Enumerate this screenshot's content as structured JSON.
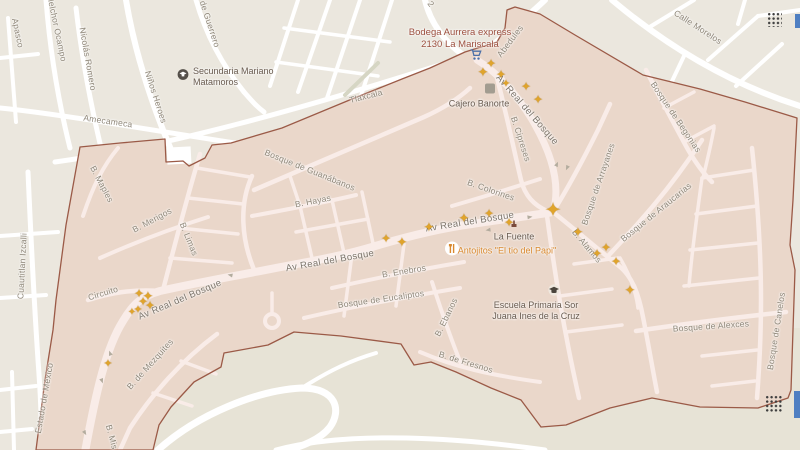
{
  "map": {
    "colors": {
      "background_outside": "#ebe7de",
      "background_outside_south": "#e7e3d6",
      "highlight_region_fill": "#ead7ca",
      "highlight_region_border": "#9b5a47",
      "road_outside": "#ffffff",
      "road_inside": "#f9ece8",
      "street_label": "#8e8678",
      "star_marker": "#e0a42c",
      "poi_shopping": "#9c4f3e",
      "poi_restaurant": "#d9892f",
      "poi_dark": "#685a4e"
    },
    "street_labels": [
      {
        "t": "Apasco",
        "x": 18,
        "y": 33,
        "r": 78,
        "c": "st",
        "s": 8.5
      },
      {
        "t": "Melchor Ocampo",
        "x": 57,
        "y": 28,
        "r": 78,
        "c": "st",
        "s": 8.5
      },
      {
        "t": "Nicolás Romero",
        "x": 88,
        "y": 59,
        "r": 80,
        "c": "st",
        "s": 8.5
      },
      {
        "t": "Niños Heroes",
        "x": 156,
        "y": 97,
        "r": 72,
        "c": "st",
        "s": 8.5
      },
      {
        "t": "de Guerrero",
        "x": 210,
        "y": 24,
        "r": 72,
        "c": "st",
        "s": 8.5
      },
      {
        "t": "Amecameca",
        "x": 108,
        "y": 121,
        "r": 8,
        "c": "st",
        "s": 8.5
      },
      {
        "t": "Tlaxcala",
        "x": 366,
        "y": 96,
        "r": -14,
        "c": "st",
        "s": 8.5
      },
      {
        "t": "2",
        "x": 431,
        "y": 4,
        "r": 55,
        "c": "st",
        "s": 8.5
      },
      {
        "t": "Calle Morelos",
        "x": 698,
        "y": 27,
        "r": 33,
        "c": "st",
        "s": 8.5
      },
      {
        "t": "Cuautitlan Izcalli",
        "x": 22,
        "y": 266,
        "r": -87,
        "c": "st",
        "s": 8.5
      },
      {
        "t": "Estado de México",
        "x": 44,
        "y": 398,
        "r": -80,
        "c": "st",
        "s": 8.5
      },
      {
        "t": "Bosque de Guanábanos",
        "x": 310,
        "y": 170,
        "r": 22,
        "c": "st",
        "s": 8.5
      },
      {
        "t": "B. Hayas",
        "x": 313,
        "y": 201,
        "r": -11,
        "c": "st",
        "s": 8.5
      },
      {
        "t": "B. Maples",
        "x": 102,
        "y": 184,
        "r": 62,
        "c": "st",
        "s": 8.5
      },
      {
        "t": "B. Merigos",
        "x": 152,
        "y": 220,
        "r": -28,
        "c": "st",
        "s": 8.5
      },
      {
        "t": "B. Limas",
        "x": 189,
        "y": 239,
        "r": 68,
        "c": "st",
        "s": 8.5
      },
      {
        "t": "Circuito",
        "x": 103,
        "y": 293,
        "r": -17,
        "c": "st",
        "s": 8.5
      },
      {
        "t": "Av Real del Bosque",
        "x": 180,
        "y": 300,
        "r": -23,
        "c": "stM",
        "s": 9.5
      },
      {
        "t": "Av Real del Bosque",
        "x": 330,
        "y": 261,
        "r": -10,
        "c": "stM",
        "s": 9.5
      },
      {
        "t": "Av Real del Bosque",
        "x": 470,
        "y": 222,
        "r": -9,
        "c": "stM",
        "s": 9.5
      },
      {
        "t": "Av Real del Bosque",
        "x": 527,
        "y": 110,
        "r": 49,
        "c": "stM",
        "s": 9.5
      },
      {
        "t": "Abedules",
        "x": 510,
        "y": 41,
        "r": -53,
        "c": "st",
        "s": 8.5
      },
      {
        "t": "B. Cipreses",
        "x": 521,
        "y": 139,
        "r": 72,
        "c": "st",
        "s": 8.5
      },
      {
        "t": "B. Colorines",
        "x": 491,
        "y": 190,
        "r": 19,
        "c": "st",
        "s": 8.5
      },
      {
        "t": "Bosque de Arrayanes",
        "x": 598,
        "y": 184,
        "r": -71,
        "c": "st",
        "s": 8.5
      },
      {
        "t": "Bosque de Araucarias",
        "x": 656,
        "y": 212,
        "r": -39,
        "c": "st",
        "s": 8.5
      },
      {
        "t": "B. Alamos",
        "x": 587,
        "y": 246,
        "r": 50,
        "c": "st",
        "s": 8.5
      },
      {
        "t": "Bosque de Begonias",
        "x": 676,
        "y": 117,
        "r": 56,
        "c": "st",
        "s": 8.5
      },
      {
        "t": "Bosque de Alexces",
        "x": 711,
        "y": 326,
        "r": -4,
        "c": "st",
        "s": 8.5
      },
      {
        "t": "Bosque de Canelos",
        "x": 776,
        "y": 331,
        "r": -81,
        "c": "st",
        "s": 8.5
      },
      {
        "t": "B. Enebros",
        "x": 404,
        "y": 271,
        "r": -9,
        "c": "st",
        "s": 8.5
      },
      {
        "t": "Bosque de Eucaliptos",
        "x": 381,
        "y": 299,
        "r": -8,
        "c": "st",
        "s": 8.5
      },
      {
        "t": "B. Ebanos",
        "x": 446,
        "y": 317,
        "r": -64,
        "c": "st",
        "s": 8.5
      },
      {
        "t": "B. de Fresnos",
        "x": 466,
        "y": 362,
        "r": 17,
        "c": "st",
        "s": 8.5
      },
      {
        "t": "B. de Mezquites",
        "x": 150,
        "y": 364,
        "r": -48,
        "c": "st",
        "s": 8.5
      },
      {
        "t": "B. Mis",
        "x": 112,
        "y": 437,
        "r": 75,
        "c": "st",
        "s": 8.5
      }
    ],
    "poi_labels": [
      {
        "id": "secundaria",
        "lines": [
          "Secundaria Mariano",
          "Matamoros"
        ],
        "x": 227,
        "y": 76,
        "c": "poiD",
        "s": 9,
        "align": "left",
        "lx": 193
      },
      {
        "id": "bodega",
        "lines": [
          "Bodega Aurrera express",
          "2130 La Mariscala"
        ],
        "x": 460,
        "y": 39,
        "c": "poiM",
        "s": 9.5
      },
      {
        "id": "cajero",
        "lines": [
          "Cajero Banorte"
        ],
        "x": 479,
        "y": 104,
        "c": "poiD",
        "s": 9
      },
      {
        "id": "la-fuente",
        "lines": [
          "La Fuente"
        ],
        "x": 514,
        "y": 237,
        "c": "poiD",
        "s": 9
      },
      {
        "id": "antojitos",
        "lines": [
          "Antojitos \"El tio del Papi\""
        ],
        "x": 507,
        "y": 251,
        "c": "poiO",
        "s": 9
      },
      {
        "id": "escuela",
        "lines": [
          "Escuela Primaria Sor",
          "Juana Ines de la Cruz"
        ],
        "x": 536,
        "y": 311,
        "c": "poiD",
        "s": 9
      }
    ],
    "icons": [
      {
        "name": "school-icon",
        "type": "school",
        "x": 183,
        "y": 77
      },
      {
        "name": "shopping-cart-icon",
        "type": "cart",
        "x": 476,
        "y": 57
      },
      {
        "name": "atm-icon",
        "type": "atm",
        "x": 490,
        "y": 90
      },
      {
        "name": "restaurant-icon",
        "type": "restaurant",
        "x": 452,
        "y": 251
      },
      {
        "name": "fountain-icon",
        "type": "fountain",
        "x": 514,
        "y": 224
      },
      {
        "name": "graduation-cap-icon",
        "type": "gradcap",
        "x": 554,
        "y": 292
      }
    ],
    "stars": [
      {
        "x": 491,
        "y": 64,
        "s": 12
      },
      {
        "x": 483,
        "y": 73,
        "s": 13
      },
      {
        "x": 501,
        "y": 75,
        "s": 12
      },
      {
        "x": 506,
        "y": 84,
        "s": 11
      },
      {
        "x": 526,
        "y": 87,
        "s": 12
      },
      {
        "x": 538,
        "y": 100,
        "s": 12
      },
      {
        "x": 139,
        "y": 294,
        "s": 12
      },
      {
        "x": 148,
        "y": 297,
        "s": 13
      },
      {
        "x": 143,
        "y": 302,
        "s": 12
      },
      {
        "x": 150,
        "y": 306,
        "s": 12
      },
      {
        "x": 138,
        "y": 310,
        "s": 11
      },
      {
        "x": 132,
        "y": 313,
        "s": 10
      },
      {
        "x": 108,
        "y": 364,
        "s": 11
      },
      {
        "x": 386,
        "y": 239,
        "s": 12
      },
      {
        "x": 402,
        "y": 243,
        "s": 13
      },
      {
        "x": 429,
        "y": 228,
        "s": 13
      },
      {
        "x": 464,
        "y": 219,
        "s": 13
      },
      {
        "x": 489,
        "y": 214,
        "s": 12
      },
      {
        "x": 509,
        "y": 223,
        "s": 12
      },
      {
        "x": 553,
        "y": 211,
        "s": 20
      },
      {
        "x": 578,
        "y": 233,
        "s": 13
      },
      {
        "x": 597,
        "y": 254,
        "s": 12
      },
      {
        "x": 606,
        "y": 248,
        "s": 12
      },
      {
        "x": 616,
        "y": 262,
        "s": 12
      },
      {
        "x": 630,
        "y": 291,
        "s": 13
      }
    ],
    "arrows": [
      {
        "x": 230,
        "y": 275,
        "r": 192
      },
      {
        "x": 110,
        "y": 353,
        "r": 250
      },
      {
        "x": 102,
        "y": 381,
        "r": 70
      },
      {
        "x": 85,
        "y": 433,
        "r": 60
      },
      {
        "x": 557,
        "y": 164,
        "r": -65
      },
      {
        "x": 567,
        "y": 168,
        "r": 115
      },
      {
        "x": 530,
        "y": 217,
        "r": -8
      },
      {
        "x": 488,
        "y": 230,
        "r": 172
      }
    ],
    "dot_grids": [
      {
        "x": 767,
        "y": 12,
        "w": 15,
        "h": 15
      },
      {
        "x": 765,
        "y": 395,
        "w": 18,
        "h": 18
      }
    ],
    "blue_edges": [
      {
        "x": 795,
        "y": 14,
        "w": 5,
        "h": 14
      },
      {
        "x": 794,
        "y": 391,
        "w": 6,
        "h": 27
      }
    ]
  }
}
